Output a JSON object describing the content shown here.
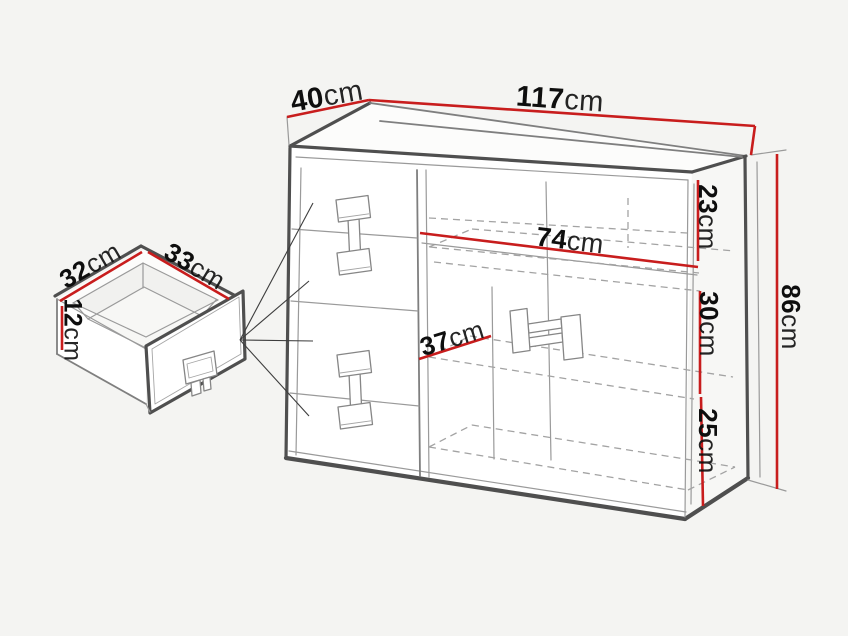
{
  "colors": {
    "background": "#f4f4f2",
    "dimension_line": "#c81d1d",
    "outline": "#4f4f4f",
    "text": "#0e0e0e"
  },
  "labels": {
    "top_depth": {
      "value": "40",
      "unit": "cm"
    },
    "top_width": {
      "value": "117",
      "unit": "cm"
    },
    "shelf_width": {
      "value": "74",
      "unit": "cm"
    },
    "inner_depth": {
      "value": "37",
      "unit": "cm"
    },
    "upper_section_height": {
      "value": "23",
      "unit": "cm"
    },
    "middle_section_height": {
      "value": "30",
      "unit": "cm"
    },
    "lower_section_height": {
      "value": "25",
      "unit": "cm"
    },
    "total_height": {
      "value": "86",
      "unit": "cm"
    },
    "drawer_width": {
      "value": "32",
      "unit": "cm"
    },
    "drawer_depth": {
      "value": "33",
      "unit": "cm"
    },
    "drawer_height": {
      "value": "12",
      "unit": "cm"
    }
  }
}
